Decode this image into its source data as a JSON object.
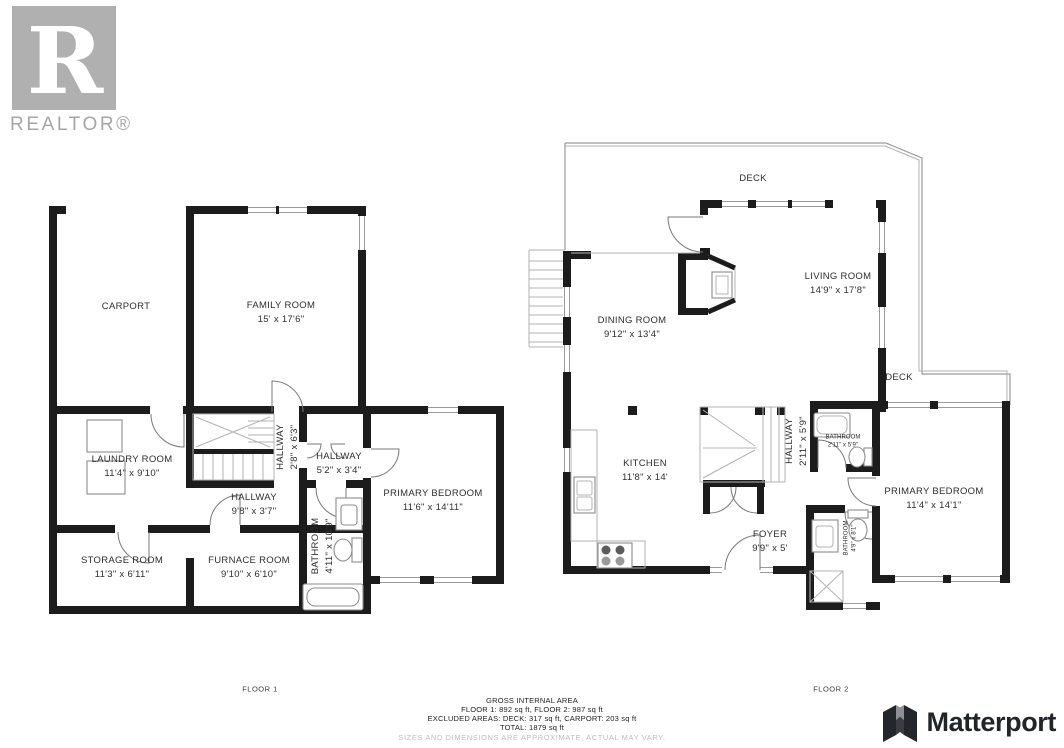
{
  "branding": {
    "realtor_letter": "R",
    "realtor_word": "REALTOR®",
    "matterport_word": "Matterport"
  },
  "floor1": {
    "label": "FLOOR 1",
    "rooms": {
      "carport": {
        "name": "CARPORT"
      },
      "family_room": {
        "name": "FAMILY ROOM",
        "dims": "15' x 17'6\""
      },
      "laundry_room": {
        "name": "LAUNDRY ROOM",
        "dims": "11'4\" x 9'10\""
      },
      "hallway_a": {
        "name": "HALLWAY",
        "dims": "2'8\" x 6'3\""
      },
      "hallway_b": {
        "name": "HALLWAY",
        "dims": "5'2\" x 3'4\""
      },
      "hallway_c": {
        "name": "HALLWAY",
        "dims": "9'8\" x 3'7\""
      },
      "primary_bedroom": {
        "name": "PRIMARY BEDROOM",
        "dims": "11'6\" x 14'11\""
      },
      "storage_room": {
        "name": "STORAGE ROOM",
        "dims": "11'3\" x 6'11\""
      },
      "furnace_room": {
        "name": "FURNACE ROOM",
        "dims": "9'10\" x 6'10\""
      },
      "bathroom": {
        "name": "BATHROOM",
        "dims": "4'11\" x 10'9\""
      }
    }
  },
  "floor2": {
    "label": "FLOOR 2",
    "rooms": {
      "deck_top": {
        "name": "DECK"
      },
      "deck_right": {
        "name": "DECK"
      },
      "living_room": {
        "name": "LIVING ROOM",
        "dims": "14'9\" x 17'8\""
      },
      "dining_room": {
        "name": "DINING ROOM",
        "dims": "9'12\" x 13'4\""
      },
      "kitchen": {
        "name": "KITCHEN",
        "dims": "11'8\" x 14'"
      },
      "hallway": {
        "name": "HALLWAY",
        "dims": "2'11\" x 5'9\""
      },
      "bathroom_upper": {
        "name": "BATHROOM",
        "dims": "2'11\" x 5'9\""
      },
      "primary_bedroom": {
        "name": "PRIMARY BEDROOM",
        "dims": "11'4\" x 14'1\""
      },
      "foyer": {
        "name": "FOYER",
        "dims": "9'9\" x 5'"
      },
      "bathroom_lower": {
        "name": "BATHROOM",
        "dims": "4'9\" x 8'1\""
      }
    }
  },
  "footer": {
    "title": "GROSS INTERNAL AREA",
    "floors": "FLOOR 1: 892 sq ft, FLOOR 2: 987 sq ft",
    "excluded": "EXCLUDED AREAS: DECK: 317 sq ft, CARPORT: 203 sq ft",
    "total": "TOTAL: 1879 sq ft",
    "disclaimer": "SIZES AND DIMENSIONS ARE APPROXIMATE, ACTUAL MAY VARY."
  },
  "colors": {
    "wall": "#1c1c1c",
    "logo_gray": "#b0b0b0",
    "disclaimer_gray": "#bdbdbd"
  }
}
